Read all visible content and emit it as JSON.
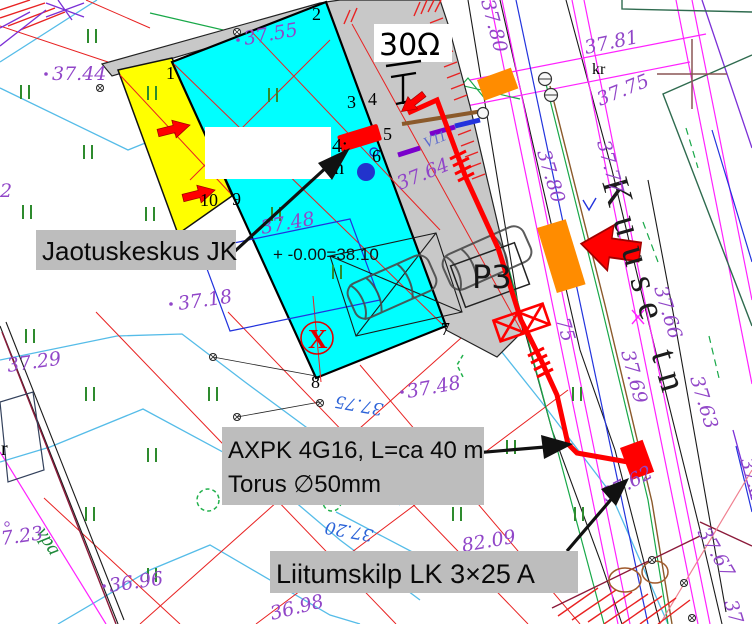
{
  "colors": {
    "building_fill": "#00FFFF",
    "terrace_fill": "#FFFF00",
    "roof_fill": "#C8C8C8",
    "cable_red": "#FF0000",
    "orange_marker": "#FF8C00",
    "elevation_purple": "#9146C8",
    "blue_note": "#2C63D8",
    "label_bg": "#BDBDBD"
  },
  "labels": {
    "jaotuskeskus": "Jaotuskeskus JK",
    "axpk_line1": "AXPK 4G16, L=ca 40 m",
    "axpk_line2": "Torus ∅50mm",
    "liitumiskilp": "Liitumskilp LK  3×25 A",
    "grounding_resistance": "30Ω",
    "street_name": "Kuuse tn",
    "parking": "P3",
    "x_marker": "X",
    "floor_level": "+ -0.00=38.10",
    "kr": "kr",
    "v11": "V11",
    "vpa": "vpa",
    "cadastral_fragment": "4:",
    "cadastral_fragment2": "n",
    "edge_fragment_left": "2",
    "edge_fragment_left2": "r",
    "elev_fragment_75": "75",
    "elev_fragment_37": "37"
  },
  "corner_numbers": [
    "1",
    "2",
    "3",
    "4",
    "5",
    "6",
    "7",
    "8",
    "9",
    "10"
  ],
  "elevations": {
    "e3744": "37.44",
    "e3755": "37.55",
    "e3780a": "37.80",
    "e3781": "37.81",
    "e3775a": "37.75",
    "e3777": "37.77",
    "e3780b": "37.80",
    "e3764": "37.64",
    "e3748a": "37.48",
    "e3718": "37.18",
    "e3729": "37.29",
    "e3748b": "37.48",
    "e3775b": "37.75",
    "e3720": "37.20",
    "e723": "7.23",
    "e3696": "36.96",
    "e3698": "36.98",
    "e8209": "82.09",
    "e3769": "37.69",
    "e3766": "37.66",
    "e3762": "37.62",
    "e3763a": "37.63",
    "e3763b": "37.63",
    "e3767": "37.67"
  }
}
